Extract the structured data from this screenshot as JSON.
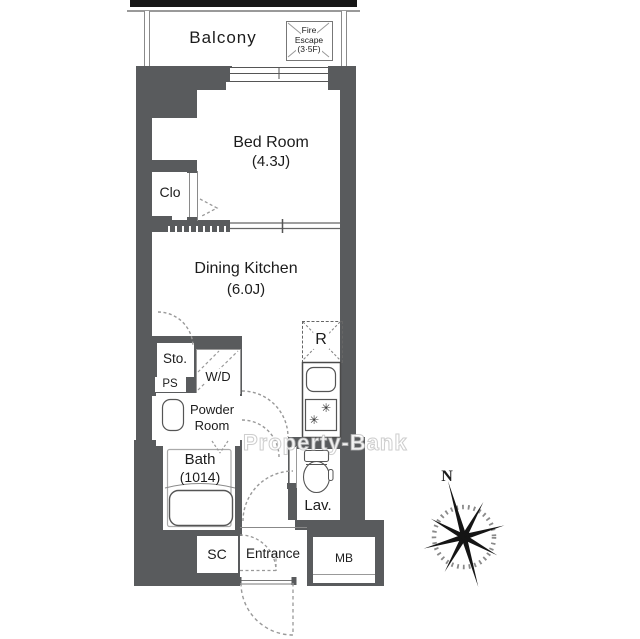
{
  "balcony": {
    "label": "Balcony"
  },
  "fire_escape": {
    "lines": [
      "Fire",
      "Escape",
      "(3·5F)"
    ]
  },
  "rooms": {
    "bedroom": {
      "name": "Bed Room",
      "size": "(4.3J)"
    },
    "dining_kitchen": {
      "name": "Dining Kitchen",
      "size": "(6.0J)"
    },
    "closet": {
      "name": "Clo"
    },
    "storage": {
      "name": "Sto."
    },
    "pipe_space": {
      "name": "PS"
    },
    "washer_dryer": {
      "name": "W/D"
    },
    "powder_room": {
      "name_line1": "Powder",
      "name_line2": "Room"
    },
    "bath": {
      "name": "Bath",
      "size": "(1014)"
    },
    "refrigerator_space": {
      "name": "R"
    },
    "lavatory": {
      "name": "Lav."
    },
    "shoe_closet": {
      "name": "SC"
    },
    "entrance": {
      "name": "Entrance"
    },
    "meter_box": {
      "name": "MB"
    }
  },
  "compass": {
    "north_label": "N"
  },
  "watermark": {
    "text": "Property-Bank"
  },
  "colors": {
    "wall": "#595b5d",
    "top_bar": "#161616",
    "line": "#5a5a5a",
    "text": "#1c1c1c",
    "watermark_text": "#ffffff"
  }
}
